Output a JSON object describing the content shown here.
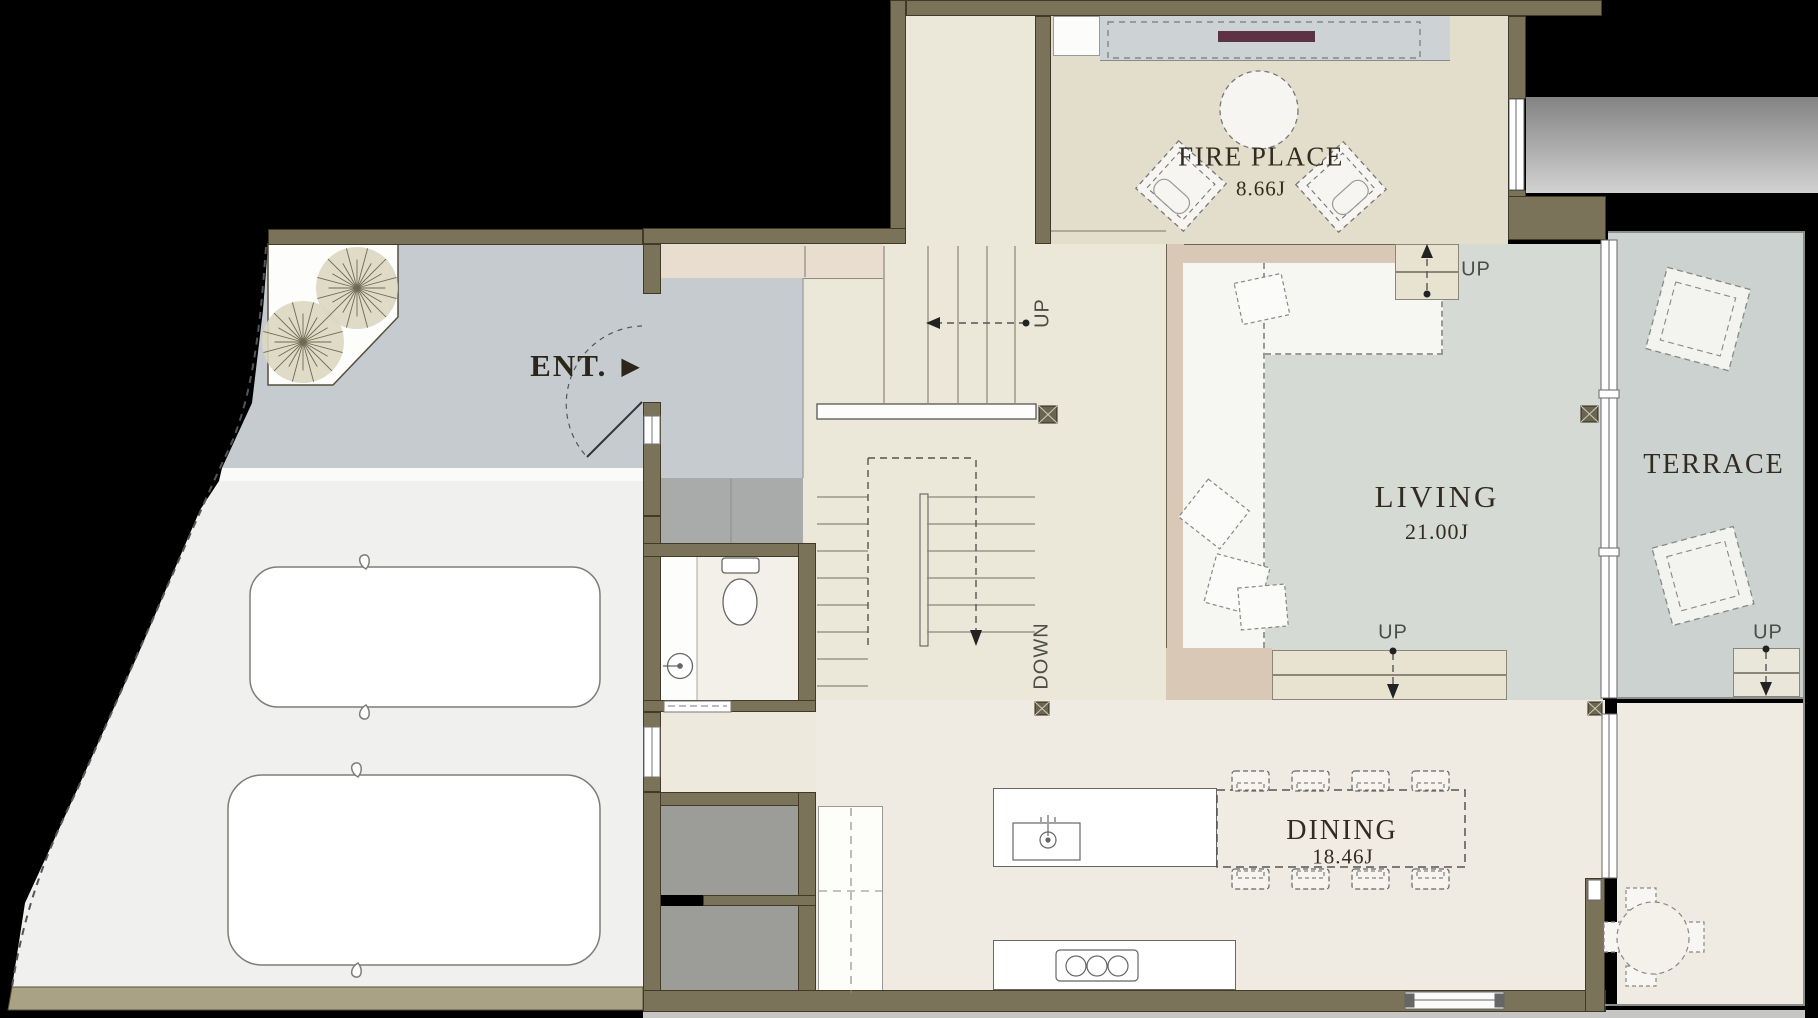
{
  "plan": {
    "rooms": {
      "fireplace": {
        "label": "FIRE PLACE",
        "area": "8.66J"
      },
      "living": {
        "label": "LIVING",
        "area": "21.00J"
      },
      "dining": {
        "label": "DINING",
        "area": "18.46J"
      },
      "terrace": {
        "label": "TERRACE"
      },
      "entrance": {
        "label": "ENT.",
        "arrow": "▶"
      }
    },
    "markers": {
      "up": "UP",
      "down": "DOWN"
    },
    "colors": {
      "background": "#000000",
      "wall": "#7a735a",
      "floor_fireplace": "#e3decb",
      "floor_hall": "#ebe7d9",
      "floor_dining": "#f0ebe2",
      "floor_living": "#d5dad5",
      "platform": "#d9c8b6",
      "approach": "#c5cbce",
      "terrace": "#ccd2d0",
      "parking": "#f0f0ee",
      "storage": "#9c9c98",
      "fireplace_accent": "#5d3245"
    }
  }
}
